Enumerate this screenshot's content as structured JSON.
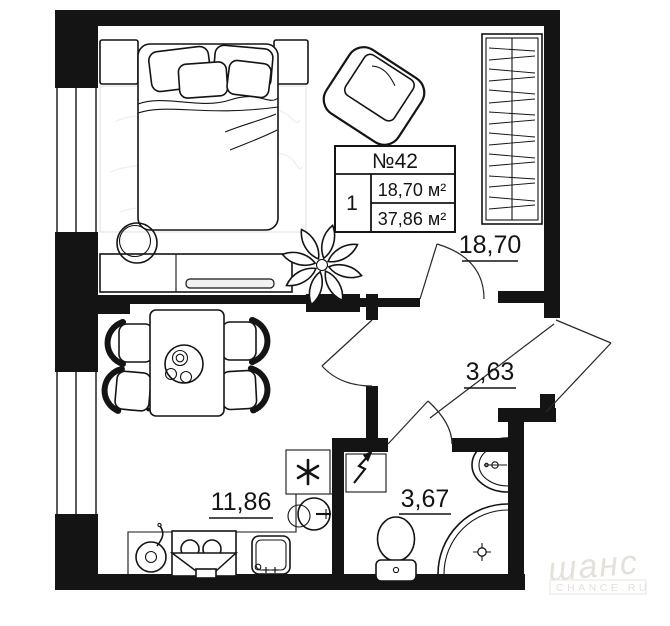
{
  "page": {
    "background": "#ffffff"
  },
  "unit_info": {
    "number": "№42",
    "rooms_count": "1",
    "living_area": "18,70 м²",
    "total_area": "37,86 м²"
  },
  "room_areas": {
    "living_room": "18,70",
    "hallway": "3,63",
    "kitchen": "11,86",
    "bathroom": "3,67"
  },
  "icons": {
    "ventilation": "six-point-asterisk",
    "electric_panel": "lightning-arrow",
    "shower_drain": "circle-cross",
    "window": "triple-line-window",
    "door": "quarter-arc-swing"
  },
  "watermark": {
    "brand": "шанс",
    "site": "CHANCE.RU"
  },
  "colors": {
    "wall": "#141414",
    "line": "#141414",
    "background": "#ffffff",
    "watermark": "#e4e1da"
  }
}
